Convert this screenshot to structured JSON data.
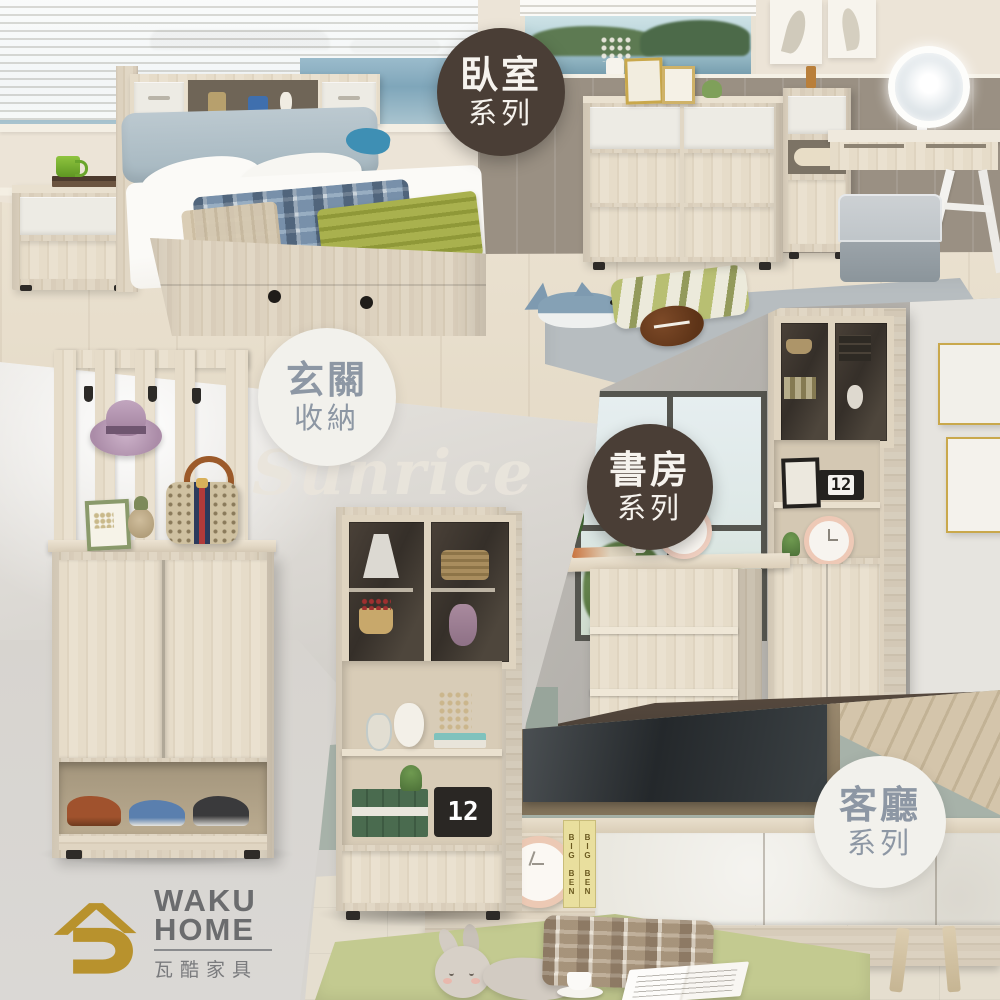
{
  "brand": {
    "name_line1": "WAKU",
    "name_line2": "HOME",
    "name_zh": "瓦酷家具"
  },
  "watermark": {
    "text": "Sunrice"
  },
  "badges": {
    "bedroom": {
      "line1": "臥室",
      "line2": "系列",
      "style": "dark"
    },
    "entryway": {
      "line1": "玄關",
      "line2": "收納",
      "style": "light"
    },
    "study": {
      "line1": "書房",
      "line2": "系列",
      "style": "dark"
    },
    "living": {
      "line1": "客廳",
      "line2": "系列",
      "style": "light"
    }
  },
  "decor": {
    "flip_calendar_day": "12",
    "book_spine": "BIG BEN"
  },
  "colors": {
    "badge_dark_bg": "#4a3e36",
    "badge_dark_text": "#f6f3ee",
    "badge_light_bg": "#f2f1ec",
    "badge_light_text": "#8d97a4",
    "logo_gold": "#b8922d",
    "logo_gray": "#6b6c6e",
    "watermark": "#eae5dc",
    "wood": "#ddd2bf",
    "taupe_wall": "#9a9083",
    "sage_wall": "#a7b2a9",
    "green_rug": "#c3ca90",
    "gray_rug": "#b7bdc0"
  }
}
